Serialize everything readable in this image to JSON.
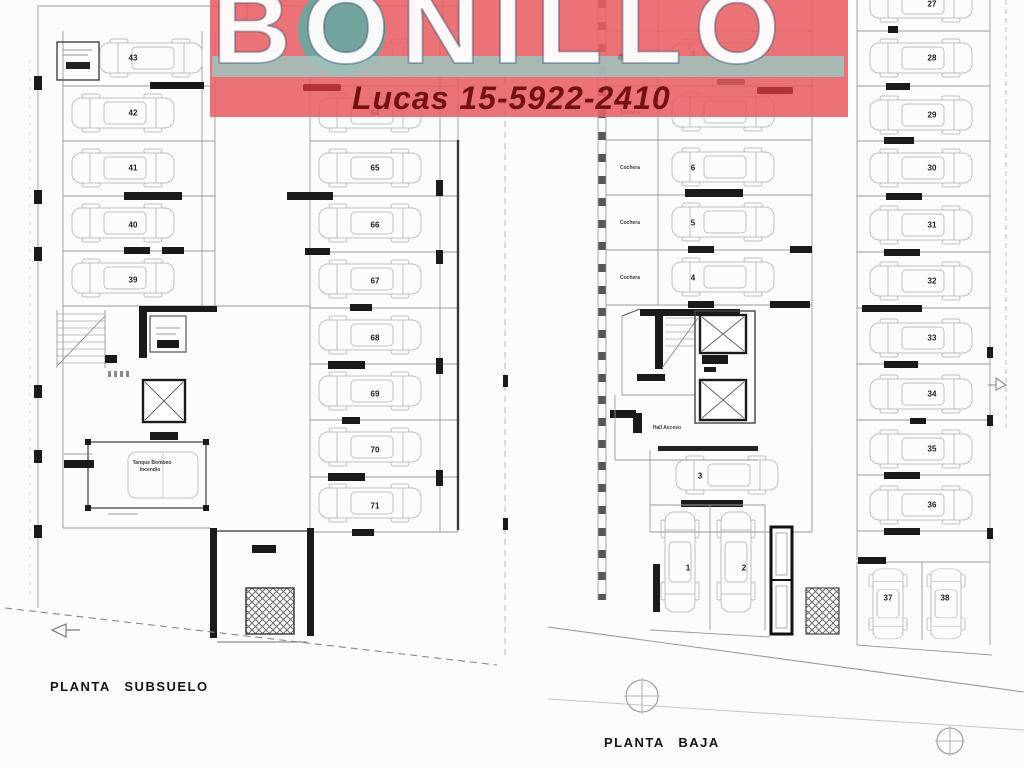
{
  "watermark": {
    "brand": "BONILLO",
    "contact": "Lucas 15-5922-2410"
  },
  "colors": {
    "banner_red": "#e85f63",
    "teal_band": "#a0c2bd",
    "teal_circle": "#69a8a2",
    "brand_text": "#ffffff",
    "contact_text": "#731114",
    "plan_line": "#9a9a9a",
    "wall_fill": "#1a1a1a"
  },
  "subsuelo": {
    "title": "PLANTA SUBSUELO",
    "left_spaces": [
      "43",
      "42",
      "41",
      "40",
      "39"
    ],
    "center_spaces": [
      "63",
      "64",
      "65",
      "66",
      "67",
      "68",
      "69",
      "70",
      "71"
    ],
    "tank_label_line1": "Tanque Bombeo",
    "tank_label_line2": "Incendio"
  },
  "baja": {
    "title": "PLANTA BAJA",
    "row_label": "Cochera",
    "hall_label": "Hall Acceso",
    "left_spaces": [
      "7",
      "6",
      "5",
      "4"
    ],
    "right_spaces": [
      "27",
      "28",
      "29",
      "30",
      "31",
      "32",
      "33",
      "34",
      "35",
      "36"
    ],
    "space_3": "3",
    "space_1": "1",
    "space_2": "2",
    "space_37": "37",
    "space_38": "38"
  }
}
